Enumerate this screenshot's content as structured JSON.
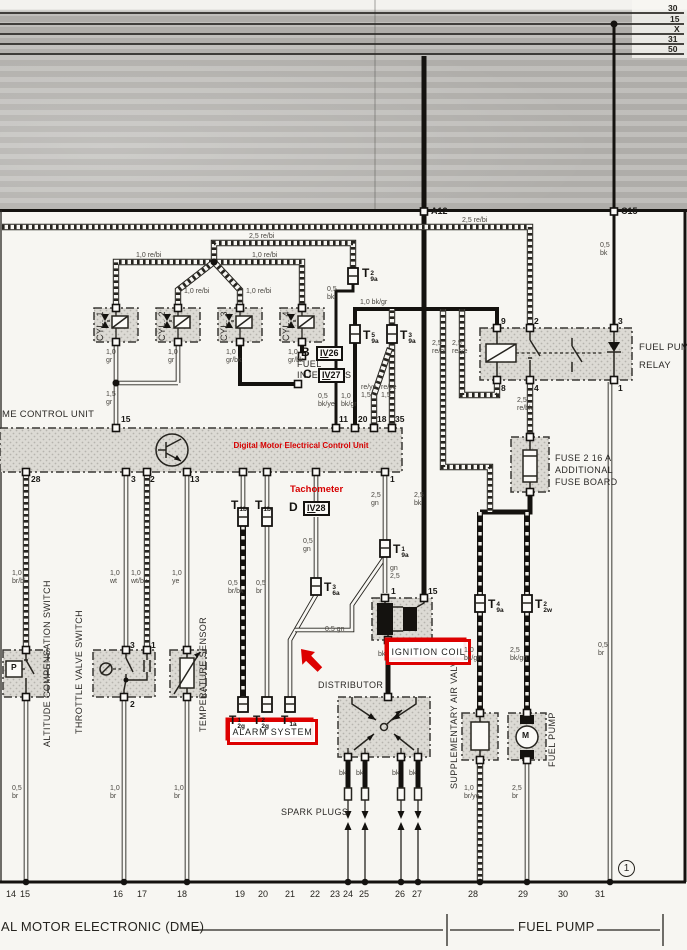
{
  "header": {
    "bus_labels": [
      "30",
      "15",
      "X",
      "31",
      "50"
    ],
    "terminal_a": "A12",
    "terminal_c": "C15"
  },
  "red_annotations": {
    "ecu": "Digital Motor Electrical Control Unit",
    "tachometer": "Tachometer",
    "ignition_coil": "IGNITION  COIL",
    "alarm_system": "ALARM  SYSTEM"
  },
  "components": {
    "ecu": "ME CONTROL UNIT",
    "cylinders": [
      "CYL. 1",
      "CYL. 2",
      "CYL. 3",
      "CYL. 4"
    ],
    "injectors_l1": "FUEL",
    "injectors_l2": "INJECTORS",
    "distributor": "DISTRIBUTOR",
    "spark_plugs": "SPARK PLUGS",
    "relay_l1": "FUEL PUMP",
    "relay_l2": "RELAY",
    "fuse_l1": "FUSE 2 16 A",
    "fuse_l2": "ADDITIONAL",
    "fuse_l3": "FUSE BOARD",
    "air_valve": "SUPPLEMENTARY AIR VALVE",
    "fuel_pump": "FUEL PUMP",
    "altitude": "ALTITUDE COMPENSATION SWITCH",
    "throttle": "THROTTLE VALVE SWITCH",
    "temp": "TEMPERATURE SENSOR"
  },
  "plugs": {
    "b": "B",
    "c": "C",
    "d": "D",
    "iv26": {
      "rn": "IV",
      "num": "26"
    },
    "iv27": {
      "rn": "IV",
      "num": "27"
    },
    "iv28": {
      "rn": "IV",
      "num": "28"
    }
  },
  "footer": {
    "dme": "AL MOTOR ELECTRONIC (DME)",
    "fuel_pump": "FUEL PUMP",
    "page_circle": "1"
  },
  "connectors": [
    {
      "sup": "2",
      "sub": "9a",
      "x": 362,
      "y": 264
    },
    {
      "sup": "5",
      "sub": "9a",
      "x": 363,
      "y": 326
    },
    {
      "sup": "3",
      "sub": "9a",
      "x": 400,
      "y": 326
    },
    {
      "sup": "1",
      "sub": "9a",
      "x": 393,
      "y": 540
    },
    {
      "sup": "3",
      "sub": "6a",
      "x": 324,
      "y": 578
    },
    {
      "sup": "4",
      "sub": "9a",
      "x": 488,
      "y": 595
    },
    {
      "sup": "2",
      "sub": "2w",
      "x": 535,
      "y": 595
    },
    {
      "sup": "",
      "sub": "1b",
      "x": 231,
      "y": 496
    },
    {
      "sup": "",
      "sub": "1b",
      "x": 255,
      "y": 496
    },
    {
      "sup": "1",
      "sub": "2g",
      "x": 229,
      "y": 711
    },
    {
      "sup": "2",
      "sub": "2g",
      "x": 253,
      "y": 711
    },
    {
      "sup": "",
      "sub": "1a",
      "x": 281,
      "y": 711
    }
  ],
  "wire_labels": [
    {
      "l": [
        "2,5  re/bi"
      ],
      "x": 249,
      "y": 233,
      "i": 1
    },
    {
      "l": [
        "1,0  re/bi"
      ],
      "x": 136,
      "y": 252,
      "i": 1
    },
    {
      "l": [
        "1,0  re/bi"
      ],
      "x": 252,
      "y": 252,
      "i": 1
    },
    {
      "l": [
        "1,0  re/bi"
      ],
      "x": 184,
      "y": 288,
      "i": 1
    },
    {
      "l": [
        "1,0  re/bi"
      ],
      "x": 246,
      "y": 288,
      "i": 1
    },
    {
      "l": [
        "2,5  re/bi"
      ],
      "x": 462,
      "y": 217,
      "i": 1
    },
    {
      "l": [
        "0,5",
        "bk"
      ],
      "x": 327,
      "y": 286
    },
    {
      "l": [
        "1,0  bk/gr"
      ],
      "x": 360,
      "y": 299,
      "i": 1
    },
    {
      "l": [
        "0,5",
        "bk"
      ],
      "x": 600,
      "y": 242
    },
    {
      "l": [
        "2,5",
        "re/bl"
      ],
      "x": 432,
      "y": 340
    },
    {
      "l": [
        "2,5",
        "re/ye"
      ],
      "x": 452,
      "y": 340
    },
    {
      "l": [
        "1,0",
        "gr"
      ],
      "x": 106,
      "y": 349
    },
    {
      "l": [
        "1,0",
        "gr"
      ],
      "x": 168,
      "y": 349
    },
    {
      "l": [
        "1,0",
        "gr/bk"
      ],
      "x": 226,
      "y": 349
    },
    {
      "l": [
        "1,0",
        "gr/bk"
      ],
      "x": 288,
      "y": 349
    },
    {
      "l": [
        "1,5",
        "gr"
      ],
      "x": 106,
      "y": 391
    },
    {
      "l": [
        "0,5",
        "bk/ye"
      ],
      "x": 318,
      "y": 393
    },
    {
      "l": [
        "1,0",
        "bk/gr"
      ],
      "x": 341,
      "y": 393
    },
    {
      "l": [
        "re/ye",
        "1,5"
      ],
      "x": 361,
      "y": 384
    },
    {
      "l": [
        "re/ye",
        "1,5"
      ],
      "x": 381,
      "y": 384
    },
    {
      "l": [
        "2,5",
        "gn"
      ],
      "x": 371,
      "y": 492
    },
    {
      "l": [
        "2,5",
        "bk"
      ],
      "x": 414,
      "y": 492
    },
    {
      "l": [
        "0,5",
        "gn"
      ],
      "x": 303,
      "y": 538
    },
    {
      "l": [
        "gn",
        "2,5"
      ],
      "x": 390,
      "y": 565
    },
    {
      "l": [
        "0,5",
        "br/bk"
      ],
      "x": 228,
      "y": 580
    },
    {
      "l": [
        "0,5",
        "br"
      ],
      "x": 256,
      "y": 580
    },
    {
      "l": [
        "0,5 gn"
      ],
      "x": 325,
      "y": 626,
      "i": 1
    },
    {
      "l": [
        "1,0",
        "br/bl"
      ],
      "x": 12,
      "y": 570
    },
    {
      "l": [
        "1,0",
        "wt"
      ],
      "x": 110,
      "y": 570
    },
    {
      "l": [
        "1,0",
        "wt/bk"
      ],
      "x": 131,
      "y": 570
    },
    {
      "l": [
        "1,0",
        "ye"
      ],
      "x": 172,
      "y": 570
    },
    {
      "l": [
        "2,5",
        "re/bk"
      ],
      "x": 517,
      "y": 397
    },
    {
      "l": [
        "1,0",
        "bk/gn"
      ],
      "x": 464,
      "y": 647
    },
    {
      "l": [
        "2,5",
        "bk/gn"
      ],
      "x": 510,
      "y": 647
    },
    {
      "l": [
        "0,5",
        "br"
      ],
      "x": 598,
      "y": 642
    },
    {
      "l": [
        "bk"
      ],
      "x": 339,
      "y": 770,
      "i": 1
    },
    {
      "l": [
        "bk"
      ],
      "x": 356,
      "y": 770,
      "i": 1
    },
    {
      "l": [
        "bk"
      ],
      "x": 392,
      "y": 770,
      "i": 1
    },
    {
      "l": [
        "bk"
      ],
      "x": 409,
      "y": 770,
      "i": 1
    },
    {
      "l": [
        "bk"
      ],
      "x": 378,
      "y": 651,
      "i": 1
    },
    {
      "l": [
        "0,5",
        "br"
      ],
      "x": 12,
      "y": 785
    },
    {
      "l": [
        "1,0",
        "br"
      ],
      "x": 110,
      "y": 785
    },
    {
      "l": [
        "1,0",
        "br"
      ],
      "x": 174,
      "y": 785
    },
    {
      "l": [
        "1,0",
        "br/ye"
      ],
      "x": 464,
      "y": 785
    },
    {
      "l": [
        "2,5",
        "br"
      ],
      "x": 512,
      "y": 785
    }
  ],
  "pins": [
    {
      "t": "15",
      "x": 121,
      "y": 414
    },
    {
      "t": "11",
      "x": 339,
      "y": 414
    },
    {
      "t": "20",
      "x": 358,
      "y": 414
    },
    {
      "t": "18",
      "x": 377,
      "y": 414
    },
    {
      "t": "35",
      "x": 395,
      "y": 414
    },
    {
      "t": "28",
      "x": 31,
      "y": 474
    },
    {
      "t": "3",
      "x": 131,
      "y": 474
    },
    {
      "t": "2",
      "x": 150,
      "y": 474
    },
    {
      "t": "13",
      "x": 190,
      "y": 474
    },
    {
      "t": "1",
      "x": 390,
      "y": 474
    },
    {
      "t": "9",
      "x": 501,
      "y": 316
    },
    {
      "t": "2",
      "x": 534,
      "y": 316
    },
    {
      "t": "3",
      "x": 618,
      "y": 316
    },
    {
      "t": "8",
      "x": 501,
      "y": 383
    },
    {
      "t": "4",
      "x": 534,
      "y": 383
    },
    {
      "t": "1",
      "x": 618,
      "y": 383
    },
    {
      "t": "3",
      "x": 130,
      "y": 640
    },
    {
      "t": "1",
      "x": 151,
      "y": 640
    },
    {
      "t": "2",
      "x": 130,
      "y": 699
    },
    {
      "t": "1",
      "x": 391,
      "y": 586
    },
    {
      "t": "15",
      "x": 428,
      "y": 586
    },
    {
      "t": "P",
      "x": 11,
      "y": 662
    },
    {
      "t": "M",
      "x": 522,
      "y": 730
    }
  ],
  "rail_numbers": [
    {
      "t": "14",
      "x": 6
    },
    {
      "t": "15",
      "x": 20
    },
    {
      "t": "16",
      "x": 113
    },
    {
      "t": "17",
      "x": 137
    },
    {
      "t": "18",
      "x": 177
    },
    {
      "t": "19",
      "x": 235
    },
    {
      "t": "20",
      "x": 258
    },
    {
      "t": "21",
      "x": 285
    },
    {
      "t": "22",
      "x": 310
    },
    {
      "t": "23",
      "x": 330
    },
    {
      "t": "24",
      "x": 343
    },
    {
      "t": "25",
      "x": 359
    },
    {
      "t": "26",
      "x": 395
    },
    {
      "t": "27",
      "x": 412
    },
    {
      "t": "28",
      "x": 468
    },
    {
      "t": "29",
      "x": 518
    },
    {
      "t": "30",
      "x": 558
    },
    {
      "t": "31",
      "x": 595
    }
  ],
  "colors": {
    "annotation_red": "#dd0000",
    "paper": "#f7f6f2",
    "scan_gray": "#b7b5b1"
  }
}
